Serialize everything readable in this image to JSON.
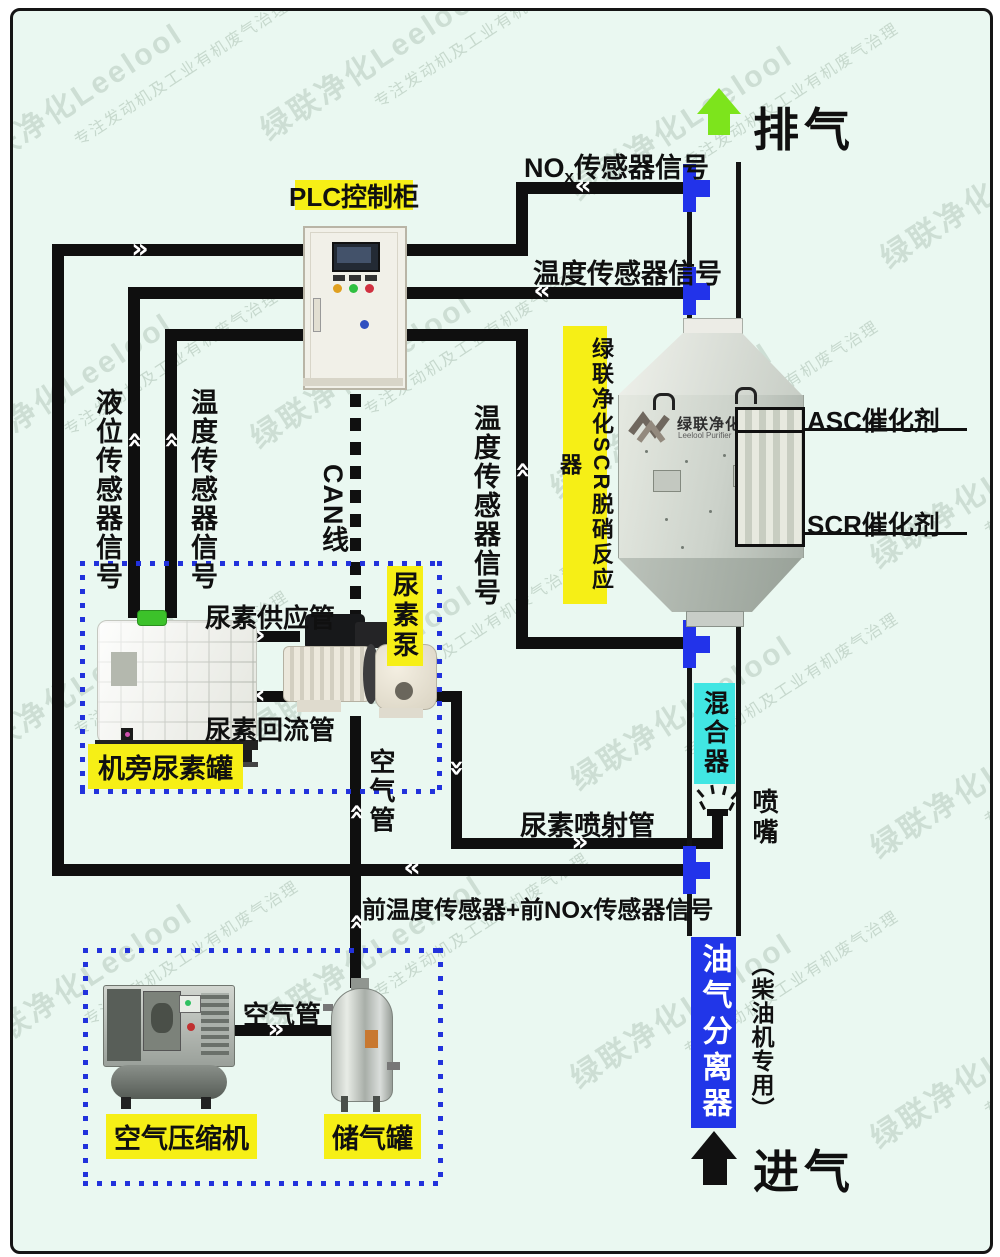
{
  "watermark": {
    "brand": "绿联净化Leelool",
    "slogan": "专注发动机及工业有机废气治理"
  },
  "flow": {
    "exhaust_label": "排气",
    "intake_label": "进气"
  },
  "plc": {
    "label": "PLC控制柜"
  },
  "signals": {
    "nox_prefix": "NO",
    "nox_sub": "x",
    "nox_suffix": "传感器信号",
    "temp_rear": "温度传感器信号",
    "level": "液位传感器信号",
    "temp_tank": "温度传感器信号",
    "temp_mid": "温度传感器信号",
    "can": "CAN线",
    "front_combo": "前温度传感器+前NOx传感器信号"
  },
  "reactor": {
    "label": "绿联净化SCR脱硝反应器",
    "logo_cn": "绿联净化",
    "logo_en": "Leelool Purifier",
    "asc": "ASC催化剂",
    "scr": "SCR催化剂"
  },
  "mixer": {
    "label": "混合器"
  },
  "nozzle": {
    "label": "喷嘴"
  },
  "pipes": {
    "injection": "尿素喷射管",
    "supply": "尿素供应管",
    "return": "尿素回流管",
    "air_vertical": "空气管",
    "air_bottom": "空气管"
  },
  "urea": {
    "pump": "尿素泵",
    "tank": "机旁尿素罐"
  },
  "separator": {
    "label": "油气分离器",
    "note": "（柴油机专用）"
  },
  "air": {
    "compressor": "空气压缩机",
    "tank": "储气罐"
  },
  "colors": {
    "background": "#eaf8f1",
    "line": "#0f0f0f",
    "highlight_yellow": "#f6ef16",
    "sensor_connector_blue": "#2233ea",
    "mixer_cyan": "#41e6e3",
    "separator_blue": "#2136e8",
    "exhaust_arrow_green": "#7de41c",
    "dotted_box_blue": "#2232dc"
  }
}
